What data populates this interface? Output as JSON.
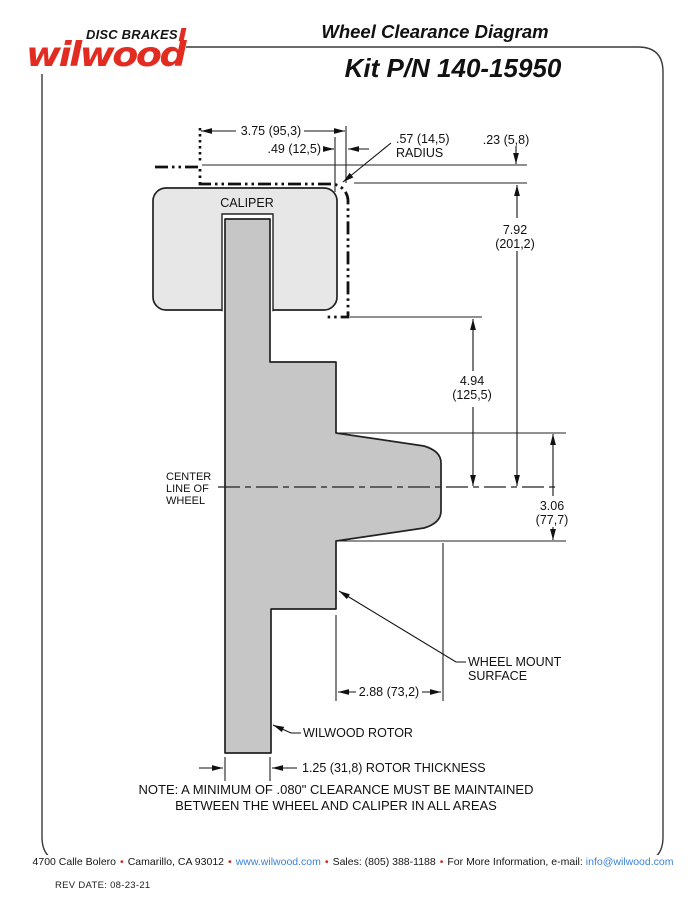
{
  "header": {
    "tagline": "DISC BRAKES",
    "brand": "wilwood",
    "title": "Wheel Clearance Diagram",
    "kit": "Kit P/N 140-15950"
  },
  "diagram": {
    "caliper_label": "CALIPER",
    "centerline_label": [
      "CENTER",
      "LINE OF",
      "WHEEL"
    ],
    "wheel_mount_label": [
      "WHEEL MOUNT",
      "SURFACE"
    ],
    "rotor_label": "WILWOOD ROTOR",
    "dims": {
      "overall_width": "3.75 (95,3)",
      "lip_offset": ".49 (12,5)",
      "radius": [
        ".57 (14,5)",
        "RADIUS"
      ],
      "wheel_lip": ".23 (5,8)",
      "wheel_depth": [
        "7.92",
        "(201,2)"
      ],
      "caliper_to_center": [
        "4.94",
        "(125,5)"
      ],
      "hat_height": [
        "3.06",
        "(77,7)"
      ],
      "mount_depth": "2.88 (73,2)",
      "rotor_thickness": "1.25 (31,8) ROTOR THICKNESS"
    },
    "note": [
      "NOTE: A MINIMUM OF .080\" CLEARANCE MUST BE MAINTAINED",
      "BETWEEN THE WHEEL AND CALIPER IN ALL AREAS"
    ]
  },
  "footer": {
    "address": "4700 Calle Bolero",
    "city": "Camarillo, CA 93012",
    "website": "www.wilwood.com",
    "sales": "Sales: (805) 388-1188",
    "info": "For More Information, e-mail:",
    "email": "info@wilwood.com",
    "separator": "•",
    "rev_date": "REV DATE:  08-23-21"
  },
  "colors": {
    "brand_red": "#e22b21",
    "link_blue": "#3b82d8",
    "bullet_red": "#d2231f",
    "caliper_gray": "#e7e7e7",
    "rotor_gray": "#c6c6c6"
  }
}
